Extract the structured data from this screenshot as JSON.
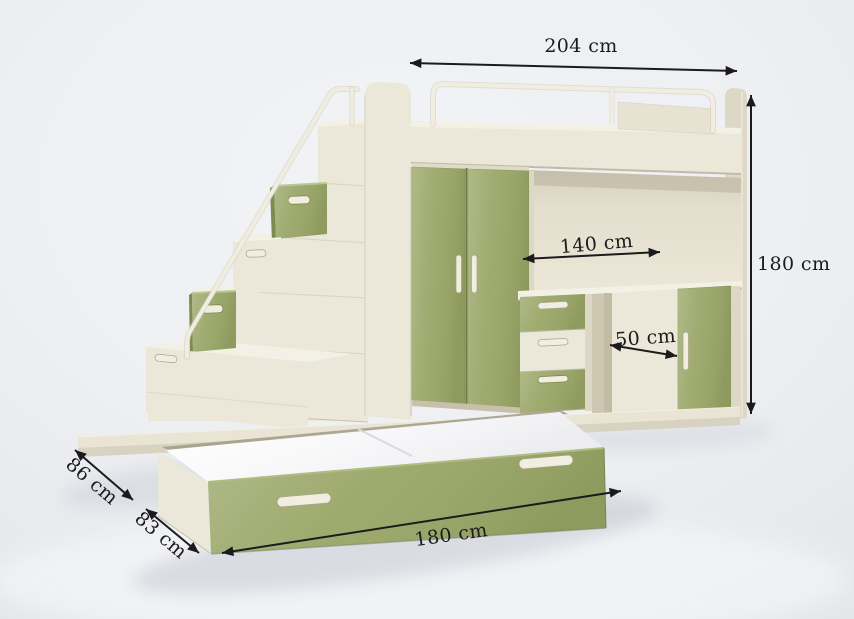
{
  "diagram": {
    "subject": "loft bed with staircase, wardrobe, desk and pull-out trundle bed",
    "dimension_labels": {
      "overall_width": "204 cm",
      "overall_height": "180 cm",
      "desk_width": "140 cm",
      "desk_depth": "50 cm",
      "upper_bed_depth": "86 cm",
      "trundle_depth": "83 cm",
      "trundle_width": "180 cm"
    },
    "colors": {
      "background": "#eceef1",
      "cream": "#ebe7d9",
      "cream_light": "#f3f0e5",
      "cream_shade": "#ddd7c6",
      "cream_dark": "#cdc6b1",
      "green": "#99a667",
      "green_dark": "#7e8b4f",
      "mattress_white": "#fdfdfe",
      "handle_cream": "#f1ede0",
      "annotation": "#1b1b1d"
    }
  }
}
